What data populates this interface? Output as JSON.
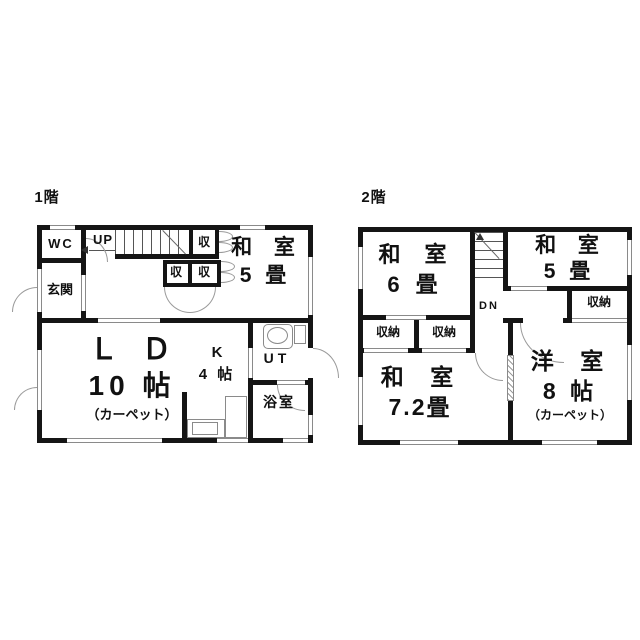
{
  "colors": {
    "wall": "#151515",
    "thin_line": "#8a8a8a",
    "text": "#111111",
    "background": "#ffffff"
  },
  "floor1": {
    "title": "1階",
    "wc": "WC",
    "up": "UP",
    "genkan": "玄関",
    "closet_top": "収",
    "closet_a": "収",
    "closet_b": "収",
    "washitsu5": {
      "l1": "和 室",
      "l2": "5 畳"
    },
    "ld": {
      "l1": "Ｌ Ｄ",
      "l2": "10 帖",
      "l3": "（カーペット）"
    },
    "kitchen": {
      "l1": "K",
      "l2": "4 帖"
    },
    "ut": "UT",
    "bath": "浴室"
  },
  "floor2": {
    "title": "2階",
    "dn": "DN",
    "washitsu6": {
      "l1": "和 室",
      "l2": "6 畳"
    },
    "washitsu5": {
      "l1": "和 室",
      "l2": "5 畳"
    },
    "storage_right": "収納",
    "storage_a": "収納",
    "storage_b": "収納",
    "washitsu72": {
      "l1": "和 室",
      "l2": "7.2畳"
    },
    "yoshitsu8": {
      "l1": "洋 室",
      "l2": "8 帖",
      "l3": "（カーペット）"
    }
  }
}
